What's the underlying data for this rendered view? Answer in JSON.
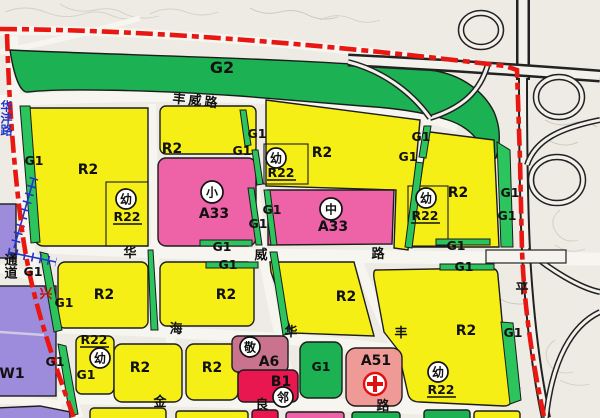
{
  "map": {
    "kind": "urban-planning zoning map excerpt",
    "zone_codes": {
      "g1": "G1",
      "g2": "G2",
      "r2": "R2",
      "r22": "R22",
      "a33": "A33",
      "a6": "A6",
      "b1": "B1",
      "a51": "A51",
      "w1": "W1"
    },
    "facility_marks": {
      "kindergarten": "幼",
      "primary_school": "小",
      "middle_school": "中",
      "elderly_care": "敬",
      "neighborhood_center": "邻",
      "hospital_cross": "red-cross"
    },
    "road_names": {
      "fengwei_road": "丰威路",
      "huawei_hua": "华",
      "huawei_wei": "威",
      "huawei_lu": "路",
      "hai": "海",
      "xing": "兴",
      "jin": "金",
      "liang": "良",
      "lu": "路",
      "hua_vertical": "华",
      "feng_vertical": "丰",
      "ping": "平",
      "left_road_partial": "华沣路",
      "corridor": "通道"
    },
    "legend_colors": {
      "residential_r2": "#f6ef15",
      "green_space": "#1cb152",
      "school_a33": "#ee62a8",
      "elderly_a6": "#c9738f",
      "commercial_b1": "#e8174f",
      "hospital_a51": "#f09a97",
      "warehouse_w1": "#9d8cdb",
      "planning_red_line": "#e81711",
      "railway_blue": "#2434c4"
    }
  }
}
